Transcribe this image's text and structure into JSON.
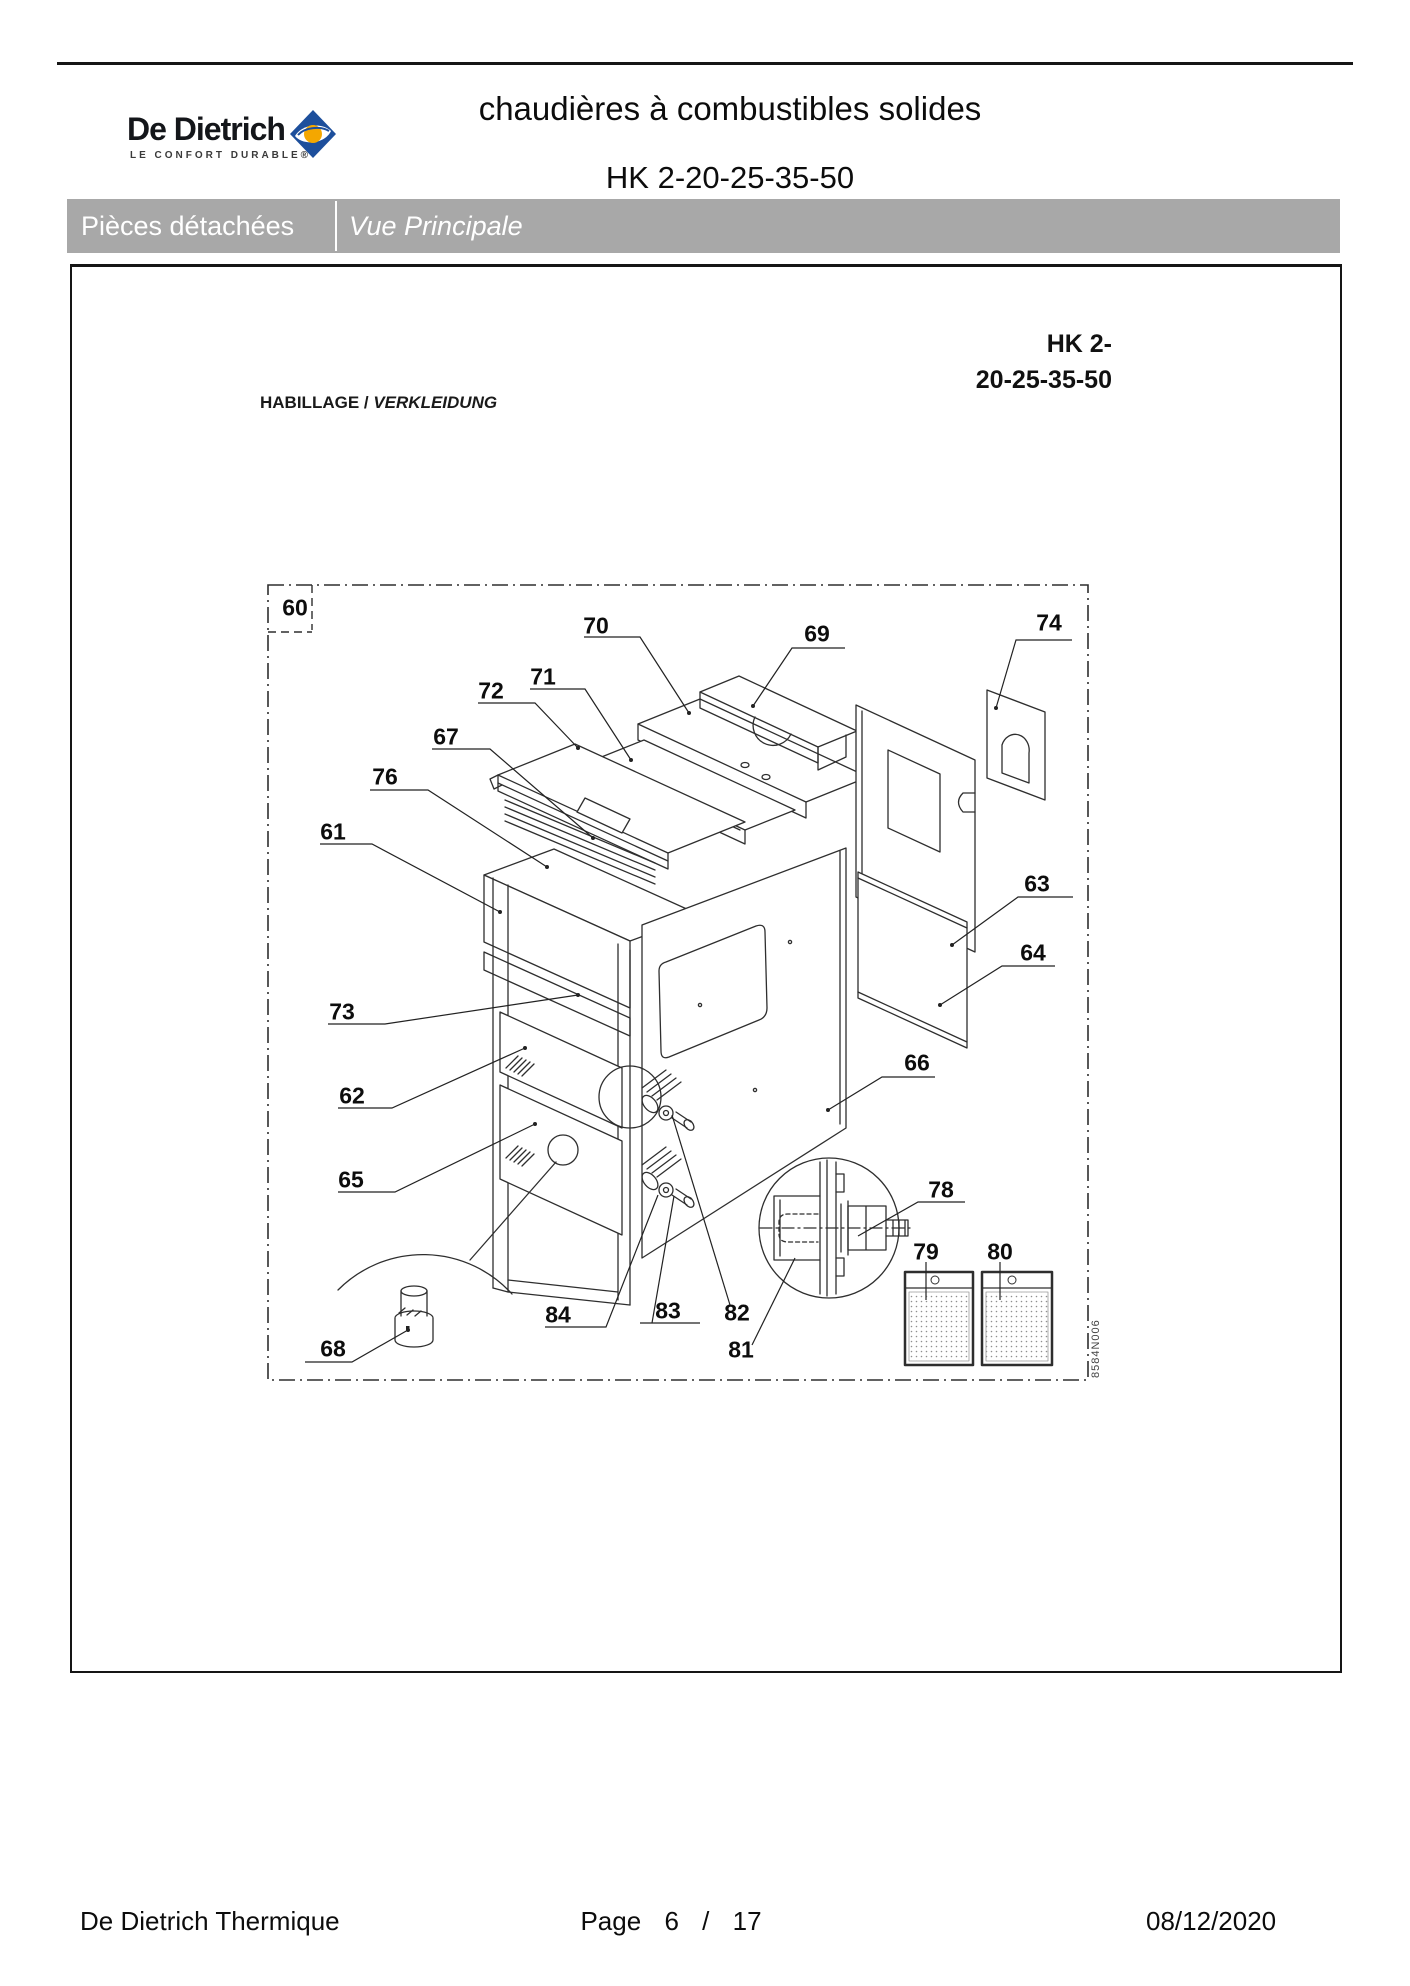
{
  "header": {
    "brand_name": "De Dietrich",
    "brand_tagline": "LE CONFORT DURABLE®",
    "doc_title": "chaudières à combustibles solides",
    "doc_subtitle": "HK 2-20-25-35-50"
  },
  "section_bar": {
    "left": "Pièces détachées",
    "right": "Vue Principale"
  },
  "diagram": {
    "model_line1": "HK 2-",
    "model_line2": "20-25-35-50",
    "caption_primary": "HABILLAGE /",
    "caption_secondary": "VERKLEIDUNG",
    "drawing_code": "8584N006",
    "callouts": [
      {
        "id": "60",
        "x": 295,
        "y": 608
      },
      {
        "id": "70",
        "x": 596,
        "y": 626
      },
      {
        "id": "69",
        "x": 817,
        "y": 634
      },
      {
        "id": "74",
        "x": 1049,
        "y": 623
      },
      {
        "id": "71",
        "x": 543,
        "y": 677
      },
      {
        "id": "72",
        "x": 491,
        "y": 691
      },
      {
        "id": "67",
        "x": 446,
        "y": 737
      },
      {
        "id": "76",
        "x": 385,
        "y": 777
      },
      {
        "id": "61",
        "x": 333,
        "y": 832
      },
      {
        "id": "63",
        "x": 1037,
        "y": 884
      },
      {
        "id": "64",
        "x": 1033,
        "y": 953
      },
      {
        "id": "73",
        "x": 342,
        "y": 1012
      },
      {
        "id": "66",
        "x": 917,
        "y": 1063
      },
      {
        "id": "62",
        "x": 352,
        "y": 1096
      },
      {
        "id": "65",
        "x": 351,
        "y": 1180
      },
      {
        "id": "78",
        "x": 941,
        "y": 1190
      },
      {
        "id": "79",
        "x": 926,
        "y": 1252
      },
      {
        "id": "80",
        "x": 1000,
        "y": 1252
      },
      {
        "id": "84",
        "x": 558,
        "y": 1315
      },
      {
        "id": "83",
        "x": 668,
        "y": 1311
      },
      {
        "id": "82",
        "x": 737,
        "y": 1313
      },
      {
        "id": "81",
        "x": 741,
        "y": 1350
      },
      {
        "id": "68",
        "x": 333,
        "y": 1349
      }
    ]
  },
  "footer": {
    "company": "De Dietrich Thermique",
    "page_word": "Page",
    "page_current": "6",
    "page_separator": "/",
    "page_total": "17",
    "date": "08/12/2020"
  }
}
